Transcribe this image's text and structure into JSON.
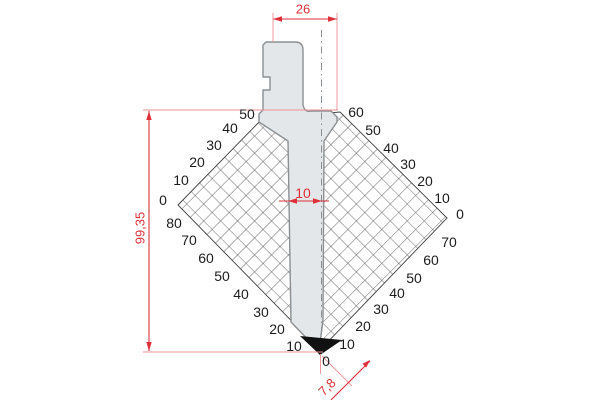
{
  "drawing": {
    "type": "press-brake punch section with angle protractor grid",
    "dimensions": {
      "top_width": "26",
      "overall_height": "99,35",
      "shaft_width": "10",
      "tip_offset": "7,8"
    },
    "tip_zero_label": "0",
    "colors": {
      "dimension_red": "#dd3038",
      "extension_pink": "#ef9096",
      "hatch_line": "#3f3f3f",
      "punch_fill": "#e4e7e9",
      "punch_outline": "#8a9094",
      "tip_black": "#111111",
      "label_black": "#1c1c1c",
      "background": "#ffffff"
    },
    "angle_labels": [
      {
        "scale": "left-top",
        "text": "50",
        "x": 247,
        "y": 114
      },
      {
        "scale": "left-top",
        "text": "40",
        "x": 230,
        "y": 128
      },
      {
        "scale": "left-top",
        "text": "30",
        "x": 214,
        "y": 145
      },
      {
        "scale": "left-top",
        "text": "20",
        "x": 197,
        "y": 162
      },
      {
        "scale": "left-top",
        "text": "10",
        "x": 181,
        "y": 180
      },
      {
        "scale": "left-top",
        "text": "0",
        "x": 163,
        "y": 200
      },
      {
        "scale": "left-bottom",
        "text": "80",
        "x": 174,
        "y": 223
      },
      {
        "scale": "left-bottom",
        "text": "70",
        "x": 189,
        "y": 240
      },
      {
        "scale": "left-bottom",
        "text": "60",
        "x": 206,
        "y": 258
      },
      {
        "scale": "left-bottom",
        "text": "50",
        "x": 222,
        "y": 276
      },
      {
        "scale": "left-bottom",
        "text": "40",
        "x": 241,
        "y": 294
      },
      {
        "scale": "left-bottom",
        "text": "30",
        "x": 261,
        "y": 312
      },
      {
        "scale": "left-bottom",
        "text": "20",
        "x": 277,
        "y": 329
      },
      {
        "scale": "left-bottom",
        "text": "10",
        "x": 294,
        "y": 346
      },
      {
        "scale": "right-top",
        "text": "60",
        "x": 356,
        "y": 112
      },
      {
        "scale": "right-top",
        "text": "50",
        "x": 373,
        "y": 130
      },
      {
        "scale": "right-top",
        "text": "40",
        "x": 391,
        "y": 148
      },
      {
        "scale": "right-top",
        "text": "30",
        "x": 408,
        "y": 164
      },
      {
        "scale": "right-top",
        "text": "20",
        "x": 425,
        "y": 181
      },
      {
        "scale": "right-top",
        "text": "10",
        "x": 442,
        "y": 198
      },
      {
        "scale": "right-top",
        "text": "0",
        "x": 460,
        "y": 214
      },
      {
        "scale": "right-bottom",
        "text": "70",
        "x": 449,
        "y": 242
      },
      {
        "scale": "right-bottom",
        "text": "60",
        "x": 431,
        "y": 260
      },
      {
        "scale": "right-bottom",
        "text": "50",
        "x": 414,
        "y": 278
      },
      {
        "scale": "right-bottom",
        "text": "40",
        "x": 397,
        "y": 293
      },
      {
        "scale": "right-bottom",
        "text": "30",
        "x": 381,
        "y": 309
      },
      {
        "scale": "right-bottom",
        "text": "20",
        "x": 363,
        "y": 326
      },
      {
        "scale": "right-bottom",
        "text": "10",
        "x": 347,
        "y": 344
      }
    ]
  }
}
